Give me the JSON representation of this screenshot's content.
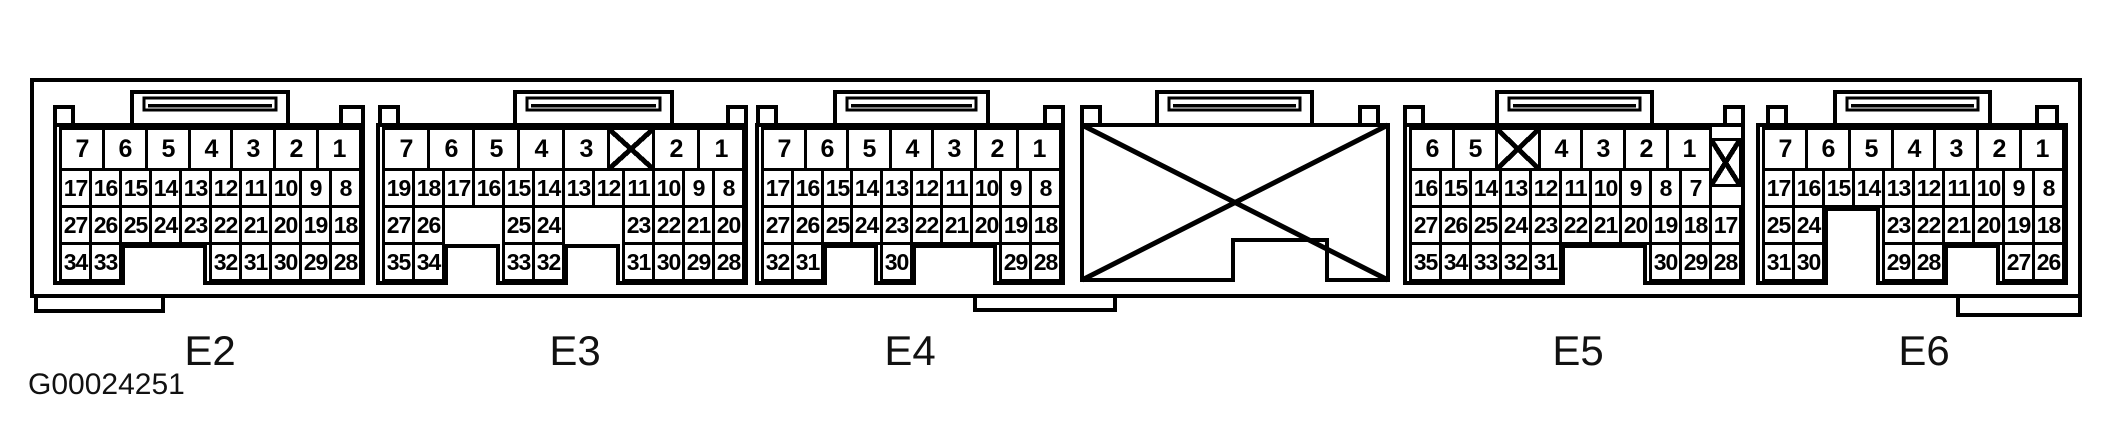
{
  "figure_label": "G00024251",
  "colors": {
    "line": "#000000",
    "background": "#ffffff"
  },
  "connectors": [
    {
      "label": "E2",
      "crossed_out": false,
      "rows": [
        {
          "cells": [
            {
              "t": "7",
              "u": 0,
              "w": 10
            },
            {
              "t": "6",
              "u": 10,
              "w": 10
            },
            {
              "t": "5",
              "u": 20,
              "w": 10
            },
            {
              "t": "4",
              "u": 30,
              "w": 10
            },
            {
              "t": "3",
              "u": 40,
              "w": 10
            },
            {
              "t": "2",
              "u": 50,
              "w": 10
            },
            {
              "t": "1",
              "u": 60,
              "w": 10
            }
          ]
        },
        {
          "cells": [
            {
              "t": "17",
              "u": 0,
              "w": 7
            },
            {
              "t": "16",
              "u": 7,
              "w": 7
            },
            {
              "t": "15",
              "u": 14,
              "w": 7
            },
            {
              "t": "14",
              "u": 21,
              "w": 7
            },
            {
              "t": "13",
              "u": 28,
              "w": 7
            },
            {
              "t": "12",
              "u": 35,
              "w": 7
            },
            {
              "t": "11",
              "u": 42,
              "w": 7
            },
            {
              "t": "10",
              "u": 49,
              "w": 7
            },
            {
              "t": "9",
              "u": 56,
              "w": 7
            },
            {
              "t": "8",
              "u": 63,
              "w": 7
            }
          ]
        },
        {
          "cells": [
            {
              "t": "27",
              "u": 0,
              "w": 7
            },
            {
              "t": "26",
              "u": 7,
              "w": 7
            },
            {
              "t": "25",
              "u": 14,
              "w": 7
            },
            {
              "t": "24",
              "u": 21,
              "w": 7
            },
            {
              "t": "23",
              "u": 28,
              "w": 7
            },
            {
              "t": "22",
              "u": 35,
              "w": 7
            },
            {
              "t": "21",
              "u": 42,
              "w": 7
            },
            {
              "t": "20",
              "u": 49,
              "w": 7
            },
            {
              "t": "19",
              "u": 56,
              "w": 7
            },
            {
              "t": "18",
              "u": 63,
              "w": 7
            }
          ]
        },
        {
          "cells": [
            {
              "t": "34",
              "u": 0,
              "w": 7
            },
            {
              "t": "33",
              "u": 7,
              "w": 7
            },
            {
              "t": "32",
              "u": 35,
              "w": 7
            },
            {
              "t": "31",
              "u": 42,
              "w": 7
            },
            {
              "t": "30",
              "u": 49,
              "w": 7
            },
            {
              "t": "29",
              "u": 56,
              "w": 7
            },
            {
              "t": "28",
              "u": 63,
              "w": 7
            }
          ]
        }
      ]
    },
    {
      "label": "E3",
      "crossed_out": false,
      "rows": [
        {
          "cells": [
            {
              "t": "7",
              "u": 0,
              "w": 3
            },
            {
              "t": "6",
              "u": 3,
              "w": 3
            },
            {
              "t": "5",
              "u": 6,
              "w": 3
            },
            {
              "t": "4",
              "u": 9,
              "w": 3
            },
            {
              "t": "3",
              "u": 12,
              "w": 3
            },
            {
              "t": "",
              "u": 15,
              "w": 3,
              "x": true
            },
            {
              "t": "2",
              "u": 18,
              "w": 3
            },
            {
              "t": "1",
              "u": 21,
              "w": 3
            }
          ]
        },
        {
          "cells": [
            {
              "t": "19",
              "u": 0,
              "w": 2
            },
            {
              "t": "18",
              "u": 2,
              "w": 2
            },
            {
              "t": "17",
              "u": 4,
              "w": 2
            },
            {
              "t": "16",
              "u": 6,
              "w": 2
            },
            {
              "t": "15",
              "u": 8,
              "w": 2
            },
            {
              "t": "14",
              "u": 10,
              "w": 2
            },
            {
              "t": "13",
              "u": 12,
              "w": 2
            },
            {
              "t": "12",
              "u": 14,
              "w": 2
            },
            {
              "t": "11",
              "u": 16,
              "w": 2
            },
            {
              "t": "10",
              "u": 18,
              "w": 2
            },
            {
              "t": "9",
              "u": 20,
              "w": 2
            },
            {
              "t": "8",
              "u": 22,
              "w": 2
            }
          ]
        },
        {
          "cells": [
            {
              "t": "27",
              "u": 0,
              "w": 2
            },
            {
              "t": "26",
              "u": 2,
              "w": 2
            },
            {
              "t": "25",
              "u": 8,
              "w": 2
            },
            {
              "t": "24",
              "u": 10,
              "w": 2
            },
            {
              "t": "23",
              "u": 16,
              "w": 2
            },
            {
              "t": "22",
              "u": 18,
              "w": 2
            },
            {
              "t": "21",
              "u": 20,
              "w": 2
            },
            {
              "t": "20",
              "u": 22,
              "w": 2
            }
          ]
        },
        {
          "cells": [
            {
              "t": "35",
              "u": 0,
              "w": 2
            },
            {
              "t": "34",
              "u": 2,
              "w": 2
            },
            {
              "t": "33",
              "u": 8,
              "w": 2
            },
            {
              "t": "32",
              "u": 10,
              "w": 2
            },
            {
              "t": "31",
              "u": 16,
              "w": 2
            },
            {
              "t": "30",
              "u": 18,
              "w": 2
            },
            {
              "t": "29",
              "u": 20,
              "w": 2
            },
            {
              "t": "28",
              "u": 22,
              "w": 2
            }
          ]
        }
      ]
    },
    {
      "label": "E4",
      "crossed_out": false,
      "rows": [
        {
          "cells": [
            {
              "t": "7",
              "u": 0,
              "w": 10
            },
            {
              "t": "6",
              "u": 10,
              "w": 10
            },
            {
              "t": "5",
              "u": 20,
              "w": 10
            },
            {
              "t": "4",
              "u": 30,
              "w": 10
            },
            {
              "t": "3",
              "u": 40,
              "w": 10
            },
            {
              "t": "2",
              "u": 50,
              "w": 10
            },
            {
              "t": "1",
              "u": 60,
              "w": 10
            }
          ]
        },
        {
          "cells": [
            {
              "t": "17",
              "u": 0,
              "w": 7
            },
            {
              "t": "16",
              "u": 7,
              "w": 7
            },
            {
              "t": "15",
              "u": 14,
              "w": 7
            },
            {
              "t": "14",
              "u": 21,
              "w": 7
            },
            {
              "t": "13",
              "u": 28,
              "w": 7
            },
            {
              "t": "12",
              "u": 35,
              "w": 7
            },
            {
              "t": "11",
              "u": 42,
              "w": 7
            },
            {
              "t": "10",
              "u": 49,
              "w": 7
            },
            {
              "t": "9",
              "u": 56,
              "w": 7
            },
            {
              "t": "8",
              "u": 63,
              "w": 7
            }
          ]
        },
        {
          "cells": [
            {
              "t": "27",
              "u": 0,
              "w": 7
            },
            {
              "t": "26",
              "u": 7,
              "w": 7
            },
            {
              "t": "25",
              "u": 14,
              "w": 7
            },
            {
              "t": "24",
              "u": 21,
              "w": 7
            },
            {
              "t": "23",
              "u": 28,
              "w": 7
            },
            {
              "t": "22",
              "u": 35,
              "w": 7
            },
            {
              "t": "21",
              "u": 42,
              "w": 7
            },
            {
              "t": "20",
              "u": 49,
              "w": 7
            },
            {
              "t": "19",
              "u": 56,
              "w": 7
            },
            {
              "t": "18",
              "u": 63,
              "w": 7
            }
          ]
        },
        {
          "cells": [
            {
              "t": "32",
              "u": 0,
              "w": 7
            },
            {
              "t": "31",
              "u": 7,
              "w": 7
            },
            {
              "t": "30",
              "u": 28,
              "w": 7
            },
            {
              "t": "29",
              "u": 56,
              "w": 7
            },
            {
              "t": "28",
              "u": 63,
              "w": 7
            }
          ]
        }
      ]
    },
    {
      "label": "",
      "crossed_out": true,
      "rows": []
    },
    {
      "label": "E5",
      "crossed_out": false,
      "rows": [
        {
          "cells": [
            {
              "t": "6",
              "u": 0,
              "w": 10
            },
            {
              "t": "5",
              "u": 10,
              "w": 10
            },
            {
              "t": "",
              "u": 20,
              "w": 10,
              "x": true
            },
            {
              "t": "4",
              "u": 30,
              "w": 10
            },
            {
              "t": "3",
              "u": 40,
              "w": 10
            },
            {
              "t": "2",
              "u": 50,
              "w": 10
            },
            {
              "t": "1",
              "u": 60,
              "w": 10
            },
            {
              "t": "",
              "u": 70,
              "w": 7,
              "x": true,
              "tall": true
            }
          ]
        },
        {
          "cells": [
            {
              "t": "16",
              "u": 0,
              "w": 7
            },
            {
              "t": "15",
              "u": 7,
              "w": 7
            },
            {
              "t": "14",
              "u": 14,
              "w": 7
            },
            {
              "t": "13",
              "u": 21,
              "w": 7
            },
            {
              "t": "12",
              "u": 28,
              "w": 7
            },
            {
              "t": "11",
              "u": 35,
              "w": 7
            },
            {
              "t": "10",
              "u": 42,
              "w": 7
            },
            {
              "t": "9",
              "u": 49,
              "w": 7
            },
            {
              "t": "8",
              "u": 56,
              "w": 7
            },
            {
              "t": "7",
              "u": 63,
              "w": 7
            }
          ]
        },
        {
          "cells": [
            {
              "t": "27",
              "u": 0,
              "w": 7
            },
            {
              "t": "26",
              "u": 7,
              "w": 7
            },
            {
              "t": "25",
              "u": 14,
              "w": 7
            },
            {
              "t": "24",
              "u": 21,
              "w": 7
            },
            {
              "t": "23",
              "u": 28,
              "w": 7
            },
            {
              "t": "22",
              "u": 35,
              "w": 7
            },
            {
              "t": "21",
              "u": 42,
              "w": 7
            },
            {
              "t": "20",
              "u": 49,
              "w": 7
            },
            {
              "t": "19",
              "u": 56,
              "w": 7
            },
            {
              "t": "18",
              "u": 63,
              "w": 7
            },
            {
              "t": "17",
              "u": 70,
              "w": 7
            }
          ]
        },
        {
          "cells": [
            {
              "t": "35",
              "u": 0,
              "w": 7
            },
            {
              "t": "34",
              "u": 7,
              "w": 7
            },
            {
              "t": "33",
              "u": 14,
              "w": 7
            },
            {
              "t": "32",
              "u": 21,
              "w": 7
            },
            {
              "t": "31",
              "u": 28,
              "w": 7
            },
            {
              "t": "30",
              "u": 56,
              "w": 7
            },
            {
              "t": "29",
              "u": 63,
              "w": 7
            },
            {
              "t": "28",
              "u": 70,
              "w": 7
            }
          ]
        }
      ]
    },
    {
      "label": "E6",
      "crossed_out": false,
      "rows": [
        {
          "cells": [
            {
              "t": "7",
              "u": 0,
              "w": 10
            },
            {
              "t": "6",
              "u": 10,
              "w": 10
            },
            {
              "t": "5",
              "u": 20,
              "w": 10
            },
            {
              "t": "4",
              "u": 30,
              "w": 10
            },
            {
              "t": "3",
              "u": 40,
              "w": 10
            },
            {
              "t": "2",
              "u": 50,
              "w": 10
            },
            {
              "t": "1",
              "u": 60,
              "w": 10
            }
          ]
        },
        {
          "cells": [
            {
              "t": "17",
              "u": 0,
              "w": 7
            },
            {
              "t": "16",
              "u": 7,
              "w": 7
            },
            {
              "t": "15",
              "u": 14,
              "w": 7
            },
            {
              "t": "14",
              "u": 21,
              "w": 7
            },
            {
              "t": "13",
              "u": 28,
              "w": 7
            },
            {
              "t": "12",
              "u": 35,
              "w": 7
            },
            {
              "t": "11",
              "u": 42,
              "w": 7
            },
            {
              "t": "10",
              "u": 49,
              "w": 7
            },
            {
              "t": "9",
              "u": 56,
              "w": 7
            },
            {
              "t": "8",
              "u": 63,
              "w": 7
            }
          ]
        },
        {
          "cells": [
            {
              "t": "25",
              "u": 0,
              "w": 7
            },
            {
              "t": "24",
              "u": 7,
              "w": 7
            },
            {
              "t": "23",
              "u": 28,
              "w": 7
            },
            {
              "t": "22",
              "u": 35,
              "w": 7
            },
            {
              "t": "21",
              "u": 42,
              "w": 7
            },
            {
              "t": "20",
              "u": 49,
              "w": 7
            },
            {
              "t": "19",
              "u": 56,
              "w": 7
            },
            {
              "t": "18",
              "u": 63,
              "w": 7
            }
          ]
        },
        {
          "cells": [
            {
              "t": "31",
              "u": 0,
              "w": 7
            },
            {
              "t": "30",
              "u": 7,
              "w": 7
            },
            {
              "t": "29",
              "u": 28,
              "w": 7
            },
            {
              "t": "28",
              "u": 35,
              "w": 7
            },
            {
              "t": "27",
              "u": 56,
              "w": 7
            },
            {
              "t": "26",
              "u": 63,
              "w": 7
            }
          ]
        }
      ]
    }
  ]
}
